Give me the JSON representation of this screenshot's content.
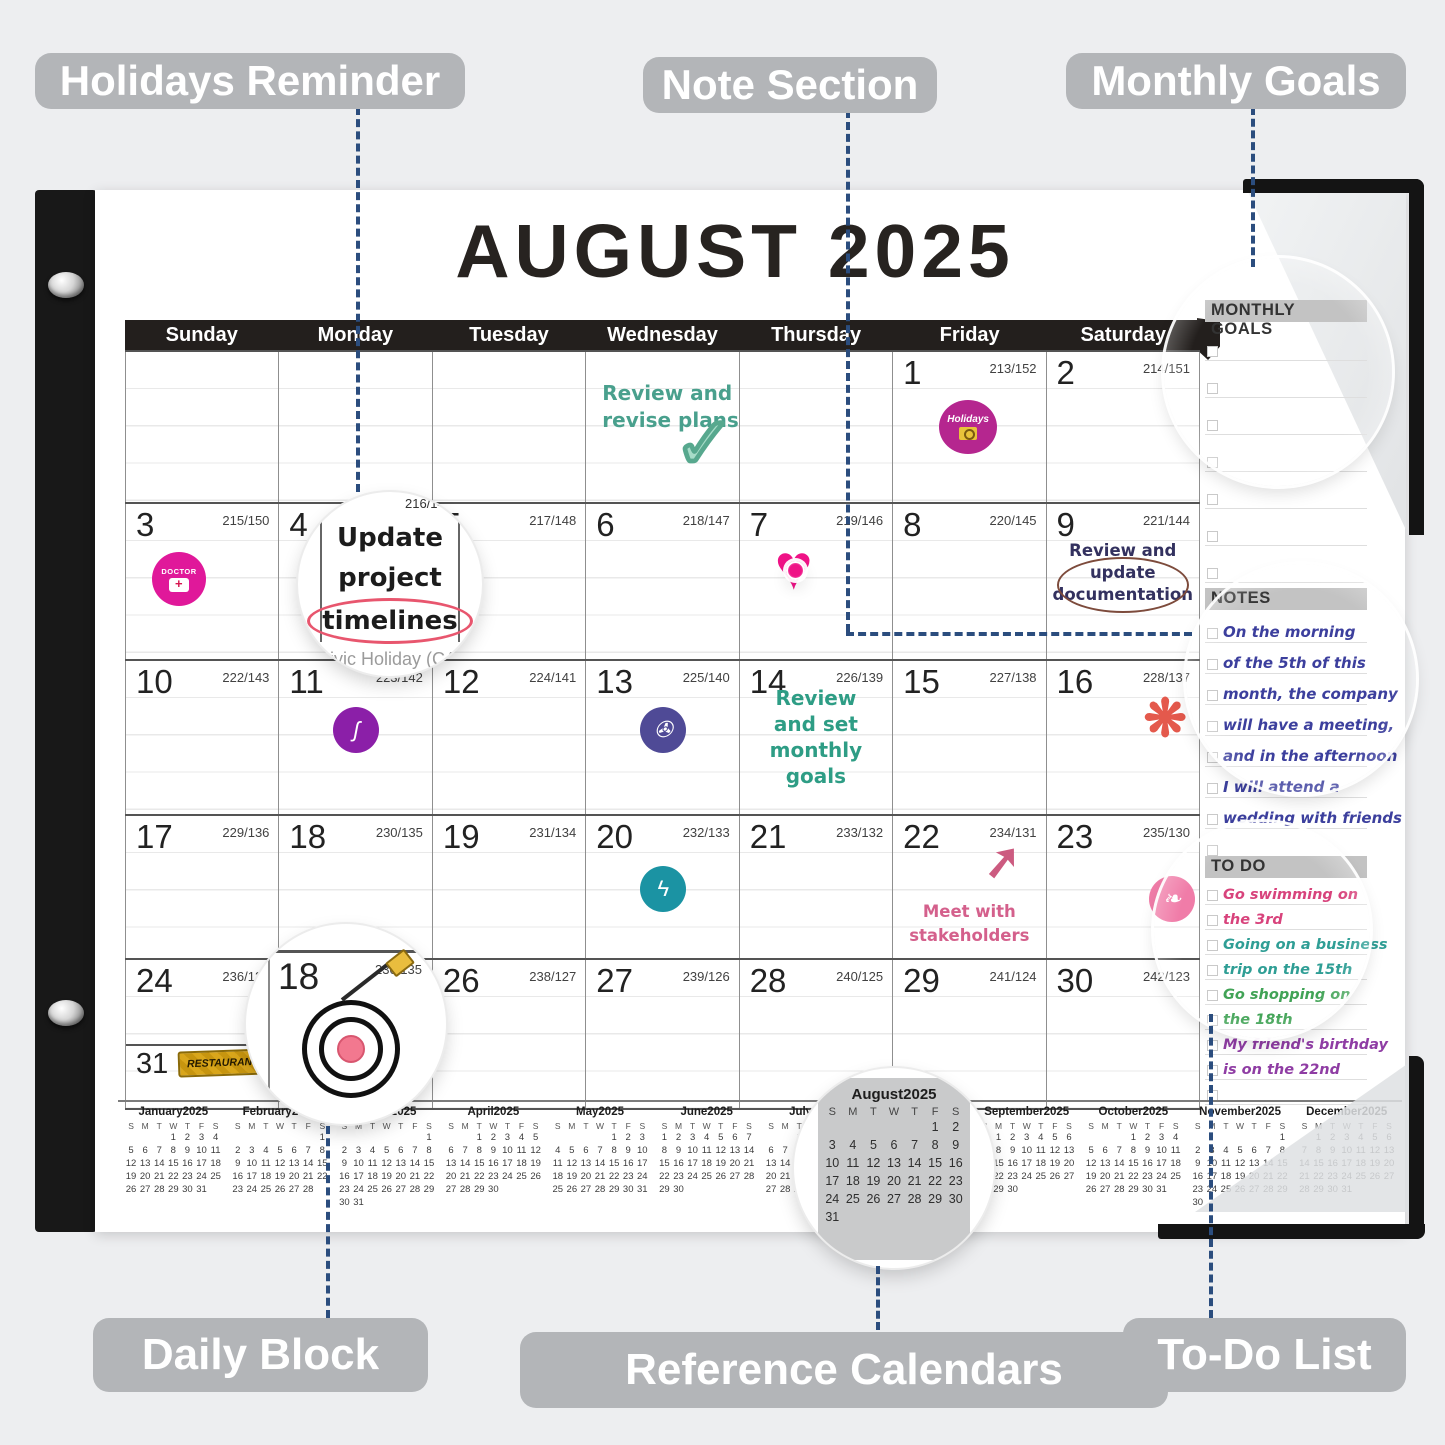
{
  "callouts": {
    "holidays": "Holidays Reminder",
    "note": "Note Section",
    "monthly": "Monthly Goals",
    "daily": "Daily Block",
    "reference": "Reference Calendars",
    "todo": "To-Do List"
  },
  "calendar": {
    "title": "AUGUST 2025",
    "day_headers": [
      "Sunday",
      "Monday",
      "Tuesday",
      "Wednesday",
      "Thursday",
      "Friday",
      "Saturday"
    ],
    "weeks": [
      [
        {},
        {},
        {},
        {
          "note": {
            "lines": [
              "Review and",
              "revise plans"
            ],
            "color": "#49a08d"
          },
          "sticker": "check"
        },
        {},
        {
          "day": "1",
          "code": "213/152",
          "sticker": "holidays"
        },
        {
          "day": "2",
          "code": "214/151"
        }
      ],
      [
        {
          "day": "3",
          "code": "215/150",
          "sticker": "doctor"
        },
        {
          "day": "4",
          "code": "216/149"
        },
        {
          "day": "5",
          "code": "217/148"
        },
        {
          "day": "6",
          "code": "218/147"
        },
        {
          "day": "7",
          "code": "219/146",
          "sticker": "heart"
        },
        {
          "day": "8",
          "code": "220/145"
        },
        {
          "day": "9",
          "code": "221/144",
          "note": {
            "lines": [
              "Review and",
              "update",
              "documentation"
            ],
            "color": "#33315f"
          }
        }
      ],
      [
        {
          "day": "10",
          "code": "222/143"
        },
        {
          "day": "11",
          "code": "223/142",
          "sticker": "ribbon"
        },
        {
          "day": "12",
          "code": "224/141"
        },
        {
          "day": "13",
          "code": "225/140",
          "sticker": "spiral"
        },
        {
          "day": "14",
          "code": "226/139",
          "note": {
            "lines": [
              "Review",
              "and set",
              "monthly",
              "goals"
            ],
            "color": "#2e9d85"
          }
        },
        {
          "day": "15",
          "code": "227/138"
        },
        {
          "day": "16",
          "code": "228/137",
          "sticker": "crab"
        }
      ],
      [
        {
          "day": "17",
          "code": "229/136"
        },
        {
          "day": "18",
          "code": "230/135"
        },
        {
          "day": "19",
          "code": "231/134"
        },
        {
          "day": "20",
          "code": "232/133",
          "sticker": "runner"
        },
        {
          "day": "21",
          "code": "233/132"
        },
        {
          "day": "22",
          "code": "234/131",
          "sticker": "arrow",
          "note": {
            "lines": [
              "Meet with",
              "stakeholders"
            ],
            "color": "#d4608c"
          }
        },
        {
          "day": "23",
          "code": "235/130",
          "sticker": "flamingo"
        }
      ],
      [
        {
          "day": "24",
          "code": "236/129",
          "day2": "31",
          "code2": "243/122",
          "sticker2": "restaurant"
        },
        {
          "day": "25",
          "code": "237/128"
        },
        {
          "day": "26",
          "code": "238/127"
        },
        {
          "day": "27",
          "code": "239/126"
        },
        {
          "day": "28",
          "code": "240/125"
        },
        {
          "day": "29",
          "code": "241/124"
        },
        {
          "day": "30",
          "code": "242/123"
        }
      ]
    ]
  },
  "magnifiers": {
    "update_note": {
      "lines": [
        "Update",
        "project",
        "timelines"
      ],
      "subtext": "Civic Holiday (CA)",
      "code": "216/149"
    },
    "daily_block": {
      "day": "18",
      "code": "230/135"
    }
  },
  "sidebar": {
    "monthly_goals": {
      "title": "MONTHLY GOALS",
      "rows": 7
    },
    "notes": {
      "title": "NOTES",
      "color": "#3c3f9d",
      "lines": [
        "On the morning",
        "of the 5th of this",
        "month, the company",
        "will have a meeting,",
        "and in the afternoon",
        "I will attend a",
        "wedding with friends",
        ""
      ]
    },
    "todo": {
      "title": "TO DO",
      "entries": [
        {
          "text": "Go swimming on",
          "color": "#d8437c"
        },
        {
          "text": "the 3rd",
          "color": "#d8437c"
        },
        {
          "text": "Going on a business",
          "color": "#2f9e95"
        },
        {
          "text": "trip on the 15th",
          "color": "#2f9e95"
        },
        {
          "text": "Go shopping on",
          "color": "#41a356"
        },
        {
          "text": "the 18th",
          "color": "#41a356"
        },
        {
          "text": "My friend's birthday",
          "color": "#8f3da4"
        },
        {
          "text": "is on the 22nd",
          "color": "#8f3da4"
        },
        {
          "text": "",
          "color": "#888888"
        }
      ]
    }
  },
  "mini_week_letters": [
    "S",
    "M",
    "T",
    "W",
    "T",
    "F",
    "S"
  ],
  "mini_months": [
    {
      "name": "January2025",
      "first_dow": 3,
      "days": 31
    },
    {
      "name": "February2025",
      "first_dow": 6,
      "days": 28
    },
    {
      "name": "March2025",
      "first_dow": 6,
      "days": 31
    },
    {
      "name": "April2025",
      "first_dow": 2,
      "days": 30
    },
    {
      "name": "May2025",
      "first_dow": 4,
      "days": 31
    },
    {
      "name": "June2025",
      "first_dow": 0,
      "days": 30
    },
    {
      "name": "July2025",
      "first_dow": 2,
      "days": 31
    },
    {
      "name": "August2025",
      "first_dow": 5,
      "days": 31
    },
    {
      "name": "September2025",
      "first_dow": 1,
      "days": 30
    },
    {
      "name": "October2025",
      "first_dow": 3,
      "days": 31
    },
    {
      "name": "November2025",
      "first_dow": 6,
      "days": 30
    },
    {
      "name": "December2025",
      "first_dow": 1,
      "days": 31
    }
  ],
  "icons": {
    "check": "✓",
    "heart": "♥",
    "ribbon": "ʃ",
    "spiral": "✇",
    "crab": "❋",
    "runner": "ϟ",
    "arrow": "➚",
    "flamingo": "❧"
  },
  "stickers": {
    "holidays_label": "Holidays",
    "doctor_label": "DOCTOR",
    "restaurant_label": "RESTAURANT"
  },
  "colors": {
    "dashed_line": "#2b4d7e",
    "pill_bg": "#b3b5b8",
    "header_bar": "#231f1d",
    "sidebar_header_bg": "#c3c3c3"
  }
}
